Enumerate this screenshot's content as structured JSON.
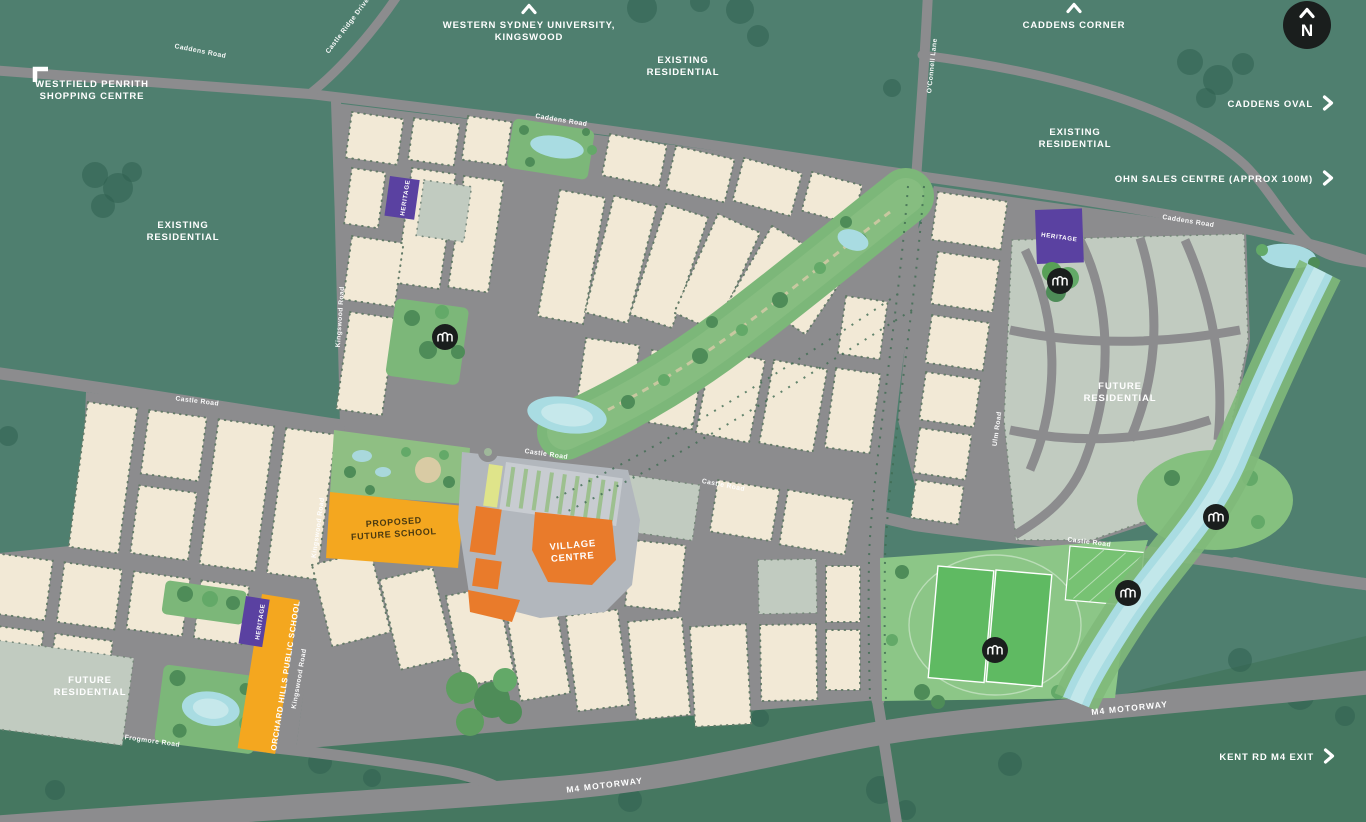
{
  "colors": {
    "background": "#4F7F6F",
    "south_band": "#457760",
    "road": "#8C8C8E",
    "motorway": "#9D929B",
    "lot_existing": "#F2E9D6",
    "lot_future": "#C1CBC0",
    "park": "#7CB779",
    "sports_field": "#5FBA62",
    "water": "#A9DCE2",
    "heritage": "#5A41A1",
    "school": "#F4A71F",
    "village_centre": "#E97B2B",
    "label": "#FFFFFF",
    "icon_badge": "#1A1E1D"
  },
  "compass": {
    "north": "N"
  },
  "offsite": {
    "westfield_line1": "WESTFIELD PENRITH",
    "westfield_line2": "SHOPPING CENTRE",
    "wsu_line1": "WESTERN SYDNEY UNIVERSITY,",
    "wsu_line2": "KINGSWOOD",
    "caddens_corner": "CADDENS CORNER",
    "caddens_oval": "CADDENS OVAL",
    "ohn_sales_centre": "OHN SALES CENTRE (APPROX 100M)",
    "kent_rd_m4_exit": "KENT RD M4 EXIT"
  },
  "areas": {
    "existing_line1": "EXISTING",
    "existing_line2": "RESIDENTIAL",
    "future_line1": "FUTURE",
    "future_line2": "RESIDENTIAL"
  },
  "sites": {
    "proposed_school_line1": "PROPOSED",
    "proposed_school_line2": "FUTURE SCHOOL",
    "village_centre_line1": "VILLAGE",
    "village_centre_line2": "CENTRE",
    "orchard_hills_school": "ORCHARD HILLS PUBLIC SCHOOL",
    "heritage": "HERITAGE"
  },
  "roads": {
    "caddens_road": "Caddens Road",
    "castle_ridge_drive": "Castle Ridge Drive",
    "oconnell_lane": "O'Connell Lane",
    "castle_road": "Castle Road",
    "kingswood_road": "Kingswood Road",
    "ulm_road": "Ulm Road",
    "frogmore_road": "Frogmore Road",
    "m4_motorway": "M4 MOTORWAY"
  }
}
